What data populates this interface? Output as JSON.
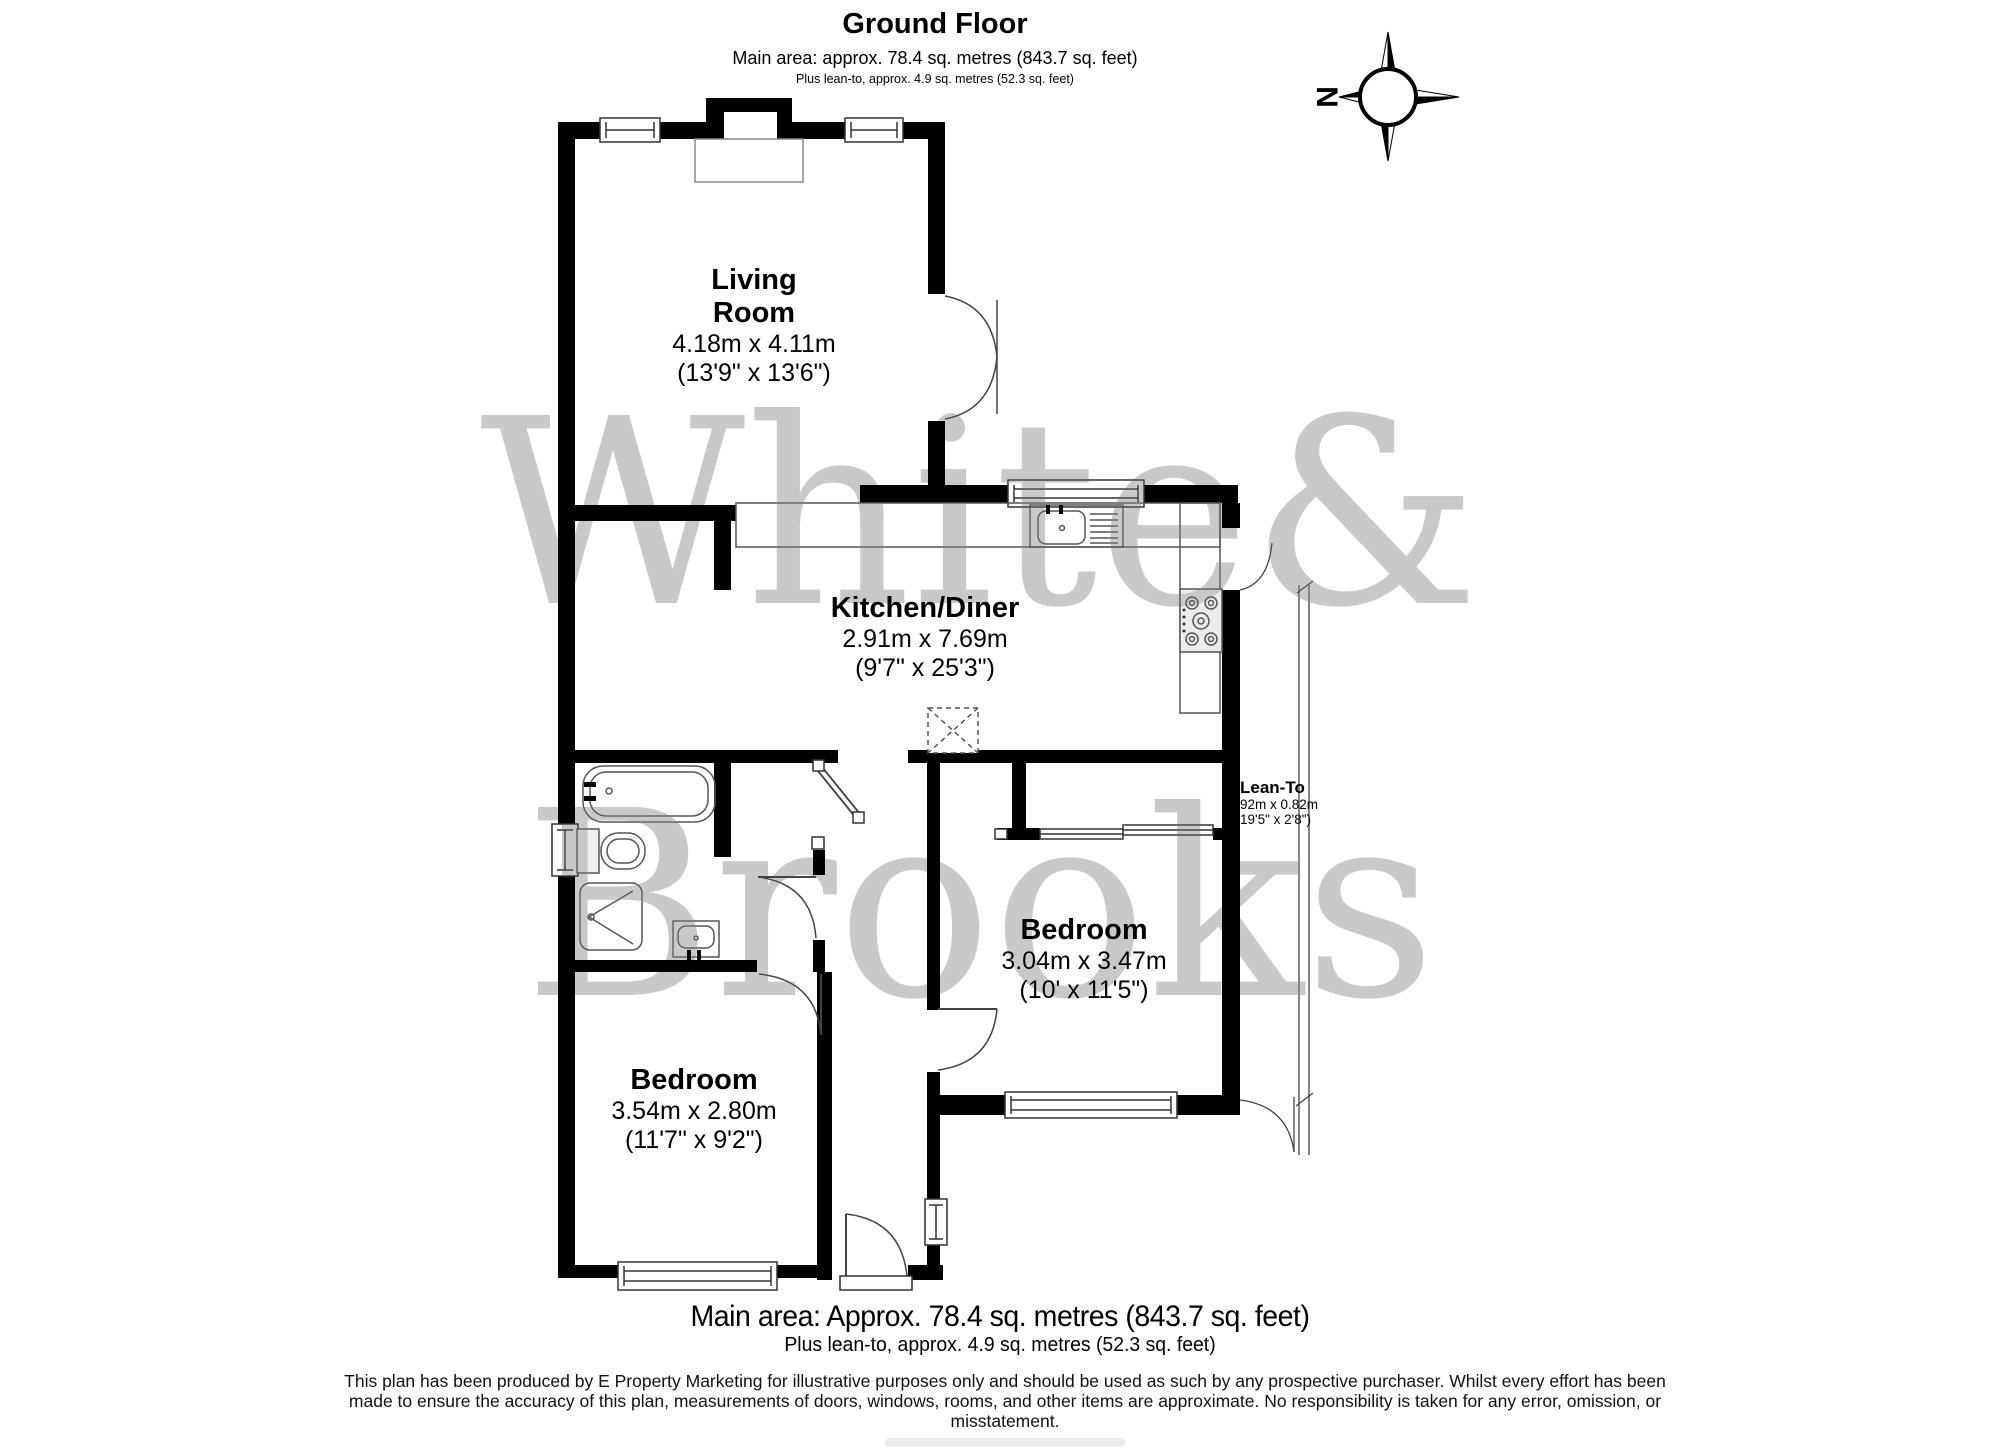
{
  "header": {
    "title": "Ground Floor",
    "subtitle": "Main area: approx. 78.4 sq. metres (843.7 sq. feet)",
    "subtitle2": "Plus lean-to, approx. 4.9 sq. metres (52.3 sq. feet)"
  },
  "compass": {
    "north_label": "N"
  },
  "watermark": {
    "line1": "White&",
    "line2": "Brooks"
  },
  "rooms": {
    "living": {
      "line1": "Living",
      "line2": "Room",
      "metric": "4.18m x 4.11m",
      "imperial": "(13'9\" x 13'6\")"
    },
    "kitchen": {
      "name": "Kitchen/Diner",
      "metric": "2.91m x 7.69m",
      "imperial": "(9'7\" x 25'3\")"
    },
    "bedroom_right": {
      "name": "Bedroom",
      "metric": "3.04m x 3.47m",
      "imperial": "(10' x 11'5\")"
    },
    "bedroom_left": {
      "name": "Bedroom",
      "metric": "3.54m x 2.80m",
      "imperial": "(11'7\" x 9'2\")"
    },
    "lean_to": {
      "name": "Lean-To",
      "metric": "92m x 0.82m",
      "imperial": "19'5\" x 2'8\")"
    }
  },
  "footer": {
    "area_main": "Main area: Approx. 78.4 sq. metres (843.7 sq. feet)",
    "area_lean": "Plus lean-to, approx. 4.9 sq. metres (52.3 sq. feet)",
    "disclaimer": "This plan has been produced by E Property Marketing for illustrative purposes only and should be used as such by any prospective purchaser. Whilst every effort has been made to ensure the accuracy of this plan, measurements of doors, windows, rooms, and other items are approximate. No responsibility is taken for any error, omission, or misstatement."
  },
  "colors": {
    "wall": "#000000",
    "fixture_line": "#555555",
    "watermark": "#c9c9c9"
  }
}
